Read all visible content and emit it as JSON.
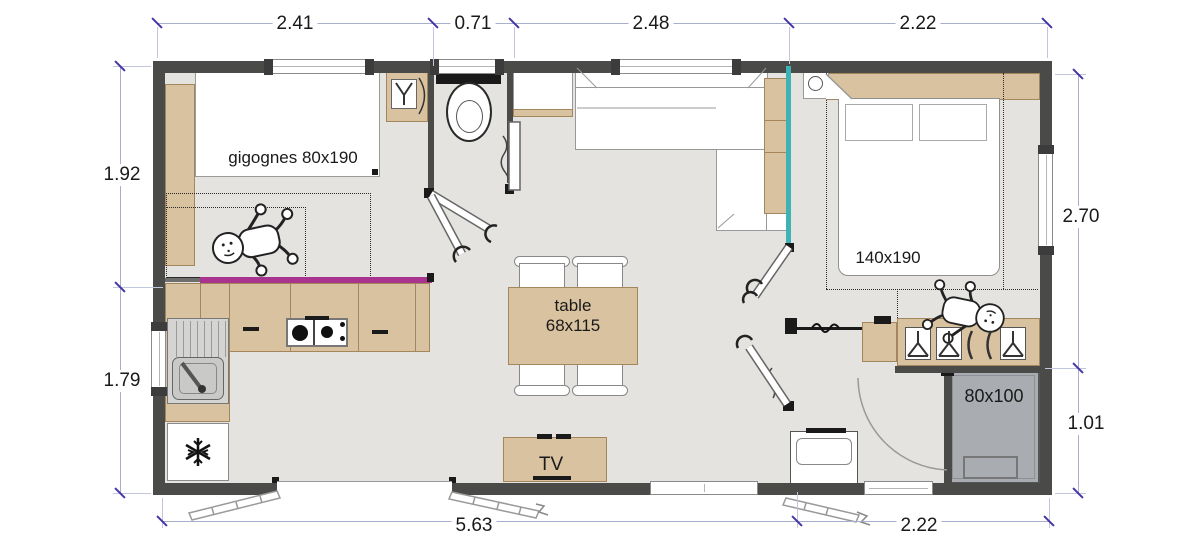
{
  "title": "mobile-home floor plan",
  "colors": {
    "wall": "#4a4a49",
    "floor": "#e5e3e0",
    "wood": "#d9c29f",
    "woodline": "#a3865c",
    "magenta": "#a8348f",
    "teal": "#3eb3b6",
    "shower": "#a9adb2",
    "dimline": "#a9aecd",
    "dimtick": "#4335a8",
    "ink": "#1a1a1a"
  },
  "dimensions": {
    "top": [
      "2.41",
      "0.71",
      "2.48",
      "2.22"
    ],
    "left": [
      "1.92",
      "1.79"
    ],
    "right": [
      "2.70",
      "1.01"
    ],
    "bottom": [
      "5.63",
      "2.22"
    ]
  },
  "labels": {
    "kids_bed": "gigognes 80x190",
    "double_bed": "140x190",
    "table_line1": "table",
    "table_line2": "68x115",
    "tv": "TV",
    "shower": "80x100"
  },
  "icons": {
    "snowflake": "fridge snowflake symbol",
    "baby": "baby figure",
    "hanger": "coat hanger",
    "toilet": "toilet bowl",
    "hob": "two-burner gas hob",
    "sink": "kitchen sink with drainer"
  }
}
